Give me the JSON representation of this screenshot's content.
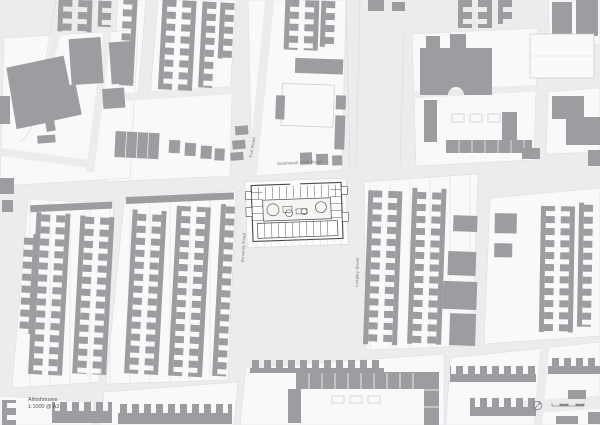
{
  "sheet": {
    "title": "Almshouses",
    "scale_note": "1:1000 @ A3"
  },
  "street_labels": {
    "southwark_park_road": "Southwark Park Road",
    "reverdy_road": "Reverdy Road",
    "longley_street": "Longley Street",
    "fort_road": "Fort Road"
  },
  "colors": {
    "paper": "#ececed",
    "building": "#9b9da0",
    "block_white": "#f8f9f9",
    "parcel_line": "#e3e5e6",
    "site_ink": "#45484b",
    "label": "#74777a",
    "title_text": "#4e5154",
    "icon": "#84878a"
  }
}
